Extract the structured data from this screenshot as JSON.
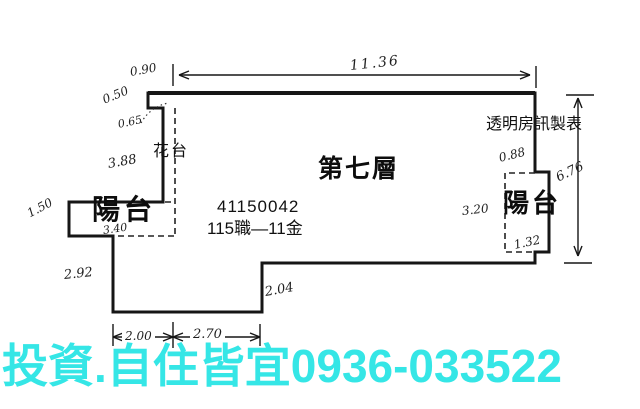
{
  "plan": {
    "floor_label": "第七層",
    "maker_label": "透明房訊製表",
    "ref_number": "41150042",
    "ref_code": "115職—11金",
    "flower_bed_label": "花台",
    "balcony_left_label": "陽台",
    "balcony_right_label": "陽台",
    "dimensions": {
      "top_width": "11.36",
      "top_offset": "0.90",
      "left_upper": "0.50",
      "left_step": "0.65",
      "left_flower_height": "3.88",
      "left_balcony_depth": "1.50",
      "left_balcony_width": "3.40",
      "left_lower_height": "2.92",
      "bottom_left": "2.00",
      "bottom_right": "2.70",
      "bottom_inner_height": "2.04",
      "right_total_height": "6.76",
      "right_balcony_offset": "0.88",
      "right_balcony_height": "3.20",
      "right_balcony_bottom": "1.32"
    },
    "line_color": "#161616"
  },
  "banner": {
    "text": "投資.自住皆宜0936-033522",
    "color": "#35e6e6"
  }
}
